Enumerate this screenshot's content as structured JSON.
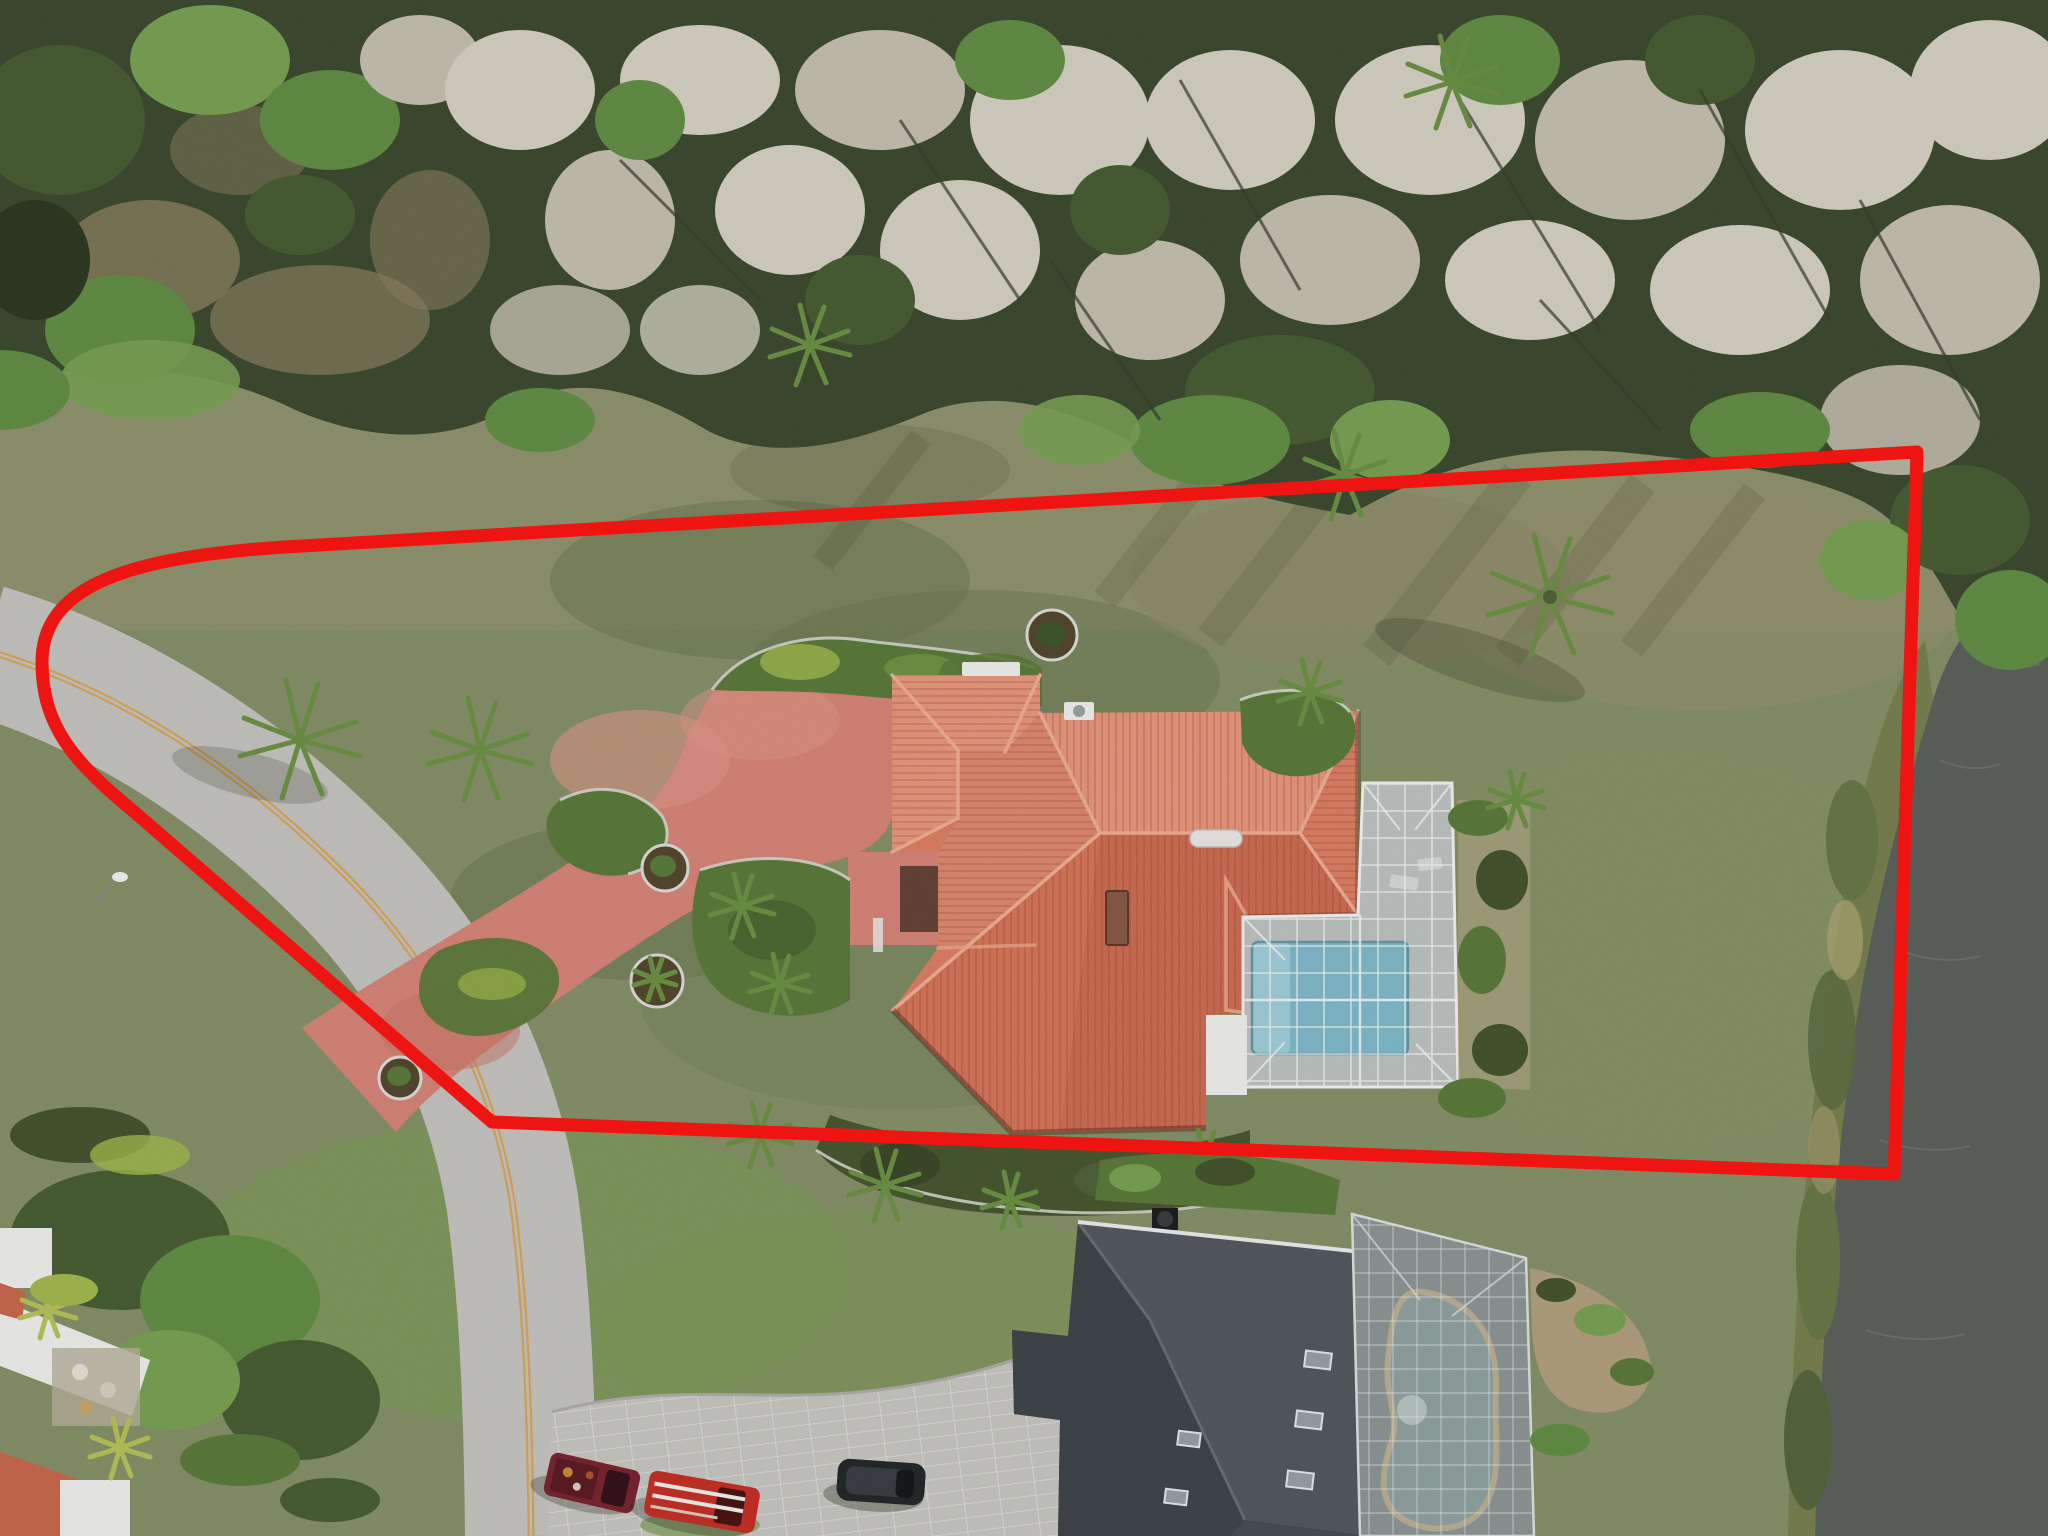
{
  "image": {
    "kind": "aerial-drone-photograph",
    "subject": "single-family estate lot outlined with a red property boundary",
    "view": "top-down",
    "width_px": 2048,
    "height_px": 1536
  },
  "boundary": {
    "color": "#ee1411",
    "stroke_px": 13,
    "style": "solid",
    "shape": "irregular quadrilateral with rounded west corner"
  },
  "palette": {
    "lawn": "#87936a",
    "lawn_bright": "#7f9c58",
    "lawn_shadow": "#6b7751",
    "upper_field": "#9a9874",
    "forest_base": "#3e4c31",
    "forest_pale": "#d7d3c6",
    "forest_green": "#649047",
    "water": "#5e635e",
    "road": "#c7c6c2",
    "road_stripe": "#d9a85c",
    "driveway": "#d9867a",
    "roof_tile": "#df8166",
    "roof_tile_light": "#e99a7e",
    "roof_tile_dark": "#d06f55",
    "roof_ridge": "#f2b096",
    "pool_water": "#82bccd",
    "screen_cage": "#c2c7c8",
    "cage_frame": "#f4f6f5",
    "neighbor_roof": "#4a4f54",
    "neighbor_pool": "#93a4a2",
    "pavers": "#c9c8c3",
    "shrubs": "#5d7c3c",
    "shrub_bright": "#a4bb4f",
    "car_maroon": "#7c2631",
    "car_red": "#c63127",
    "car_black": "#26292c",
    "curb": "#dededa"
  },
  "features": {
    "main_house": "terracotta barrel-tile hip roof with white roof vent, skylight and AC pad",
    "pool_enclosure": "L-shaped white aluminum screen cage over rectangular blue pool",
    "driveway": "red-tinted concrete drive from street to motor court and entry walk",
    "road": "curved two-lane street with double yellow center line",
    "neighbor_house": "dark shingle hip roof with skylights and screened kidney-shaped pool",
    "paver_drive": "light gray block-paver driveway with three parked vehicles",
    "vehicles": [
      "maroon pickup truck",
      "red pickup truck with ladder rack",
      "black SUV"
    ],
    "water_body": "dark pond along the right edge with grassy bank",
    "tree_line": "dense moss-draped bare trees mixed with green canopy across the top",
    "landscaping": "curbed shrub beds, circular planters and palms around house and lawn"
  }
}
